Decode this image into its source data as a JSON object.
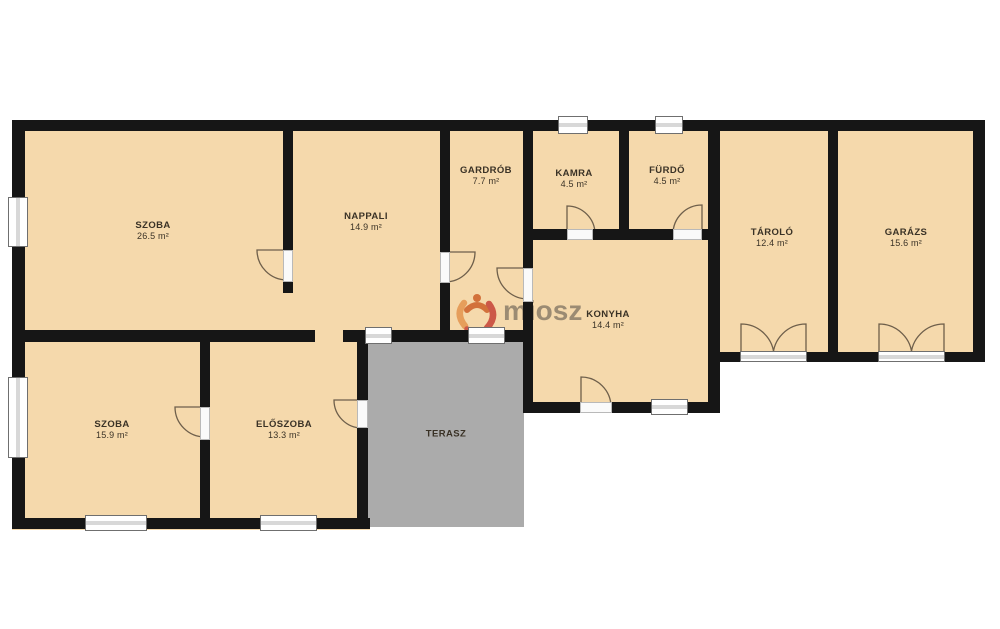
{
  "canvas": {
    "width": 1000,
    "height": 629,
    "background": "#ffffff"
  },
  "colors": {
    "wall": "#161616",
    "floor": "#f5d9ac",
    "terrace": "#ababab",
    "door_arc": "#6e5f4b",
    "label_text": "#3a3226",
    "watermark_text_color": "#8c7e6a",
    "logo_orange": "#e59a55",
    "logo_dark_orange": "#d06a33",
    "logo_red": "#c94f41"
  },
  "watermark": {
    "text": "miosz"
  },
  "rooms": [
    {
      "id": "szoba-1",
      "name": "SZOBA",
      "area": "26.5 m²",
      "cx": 153,
      "cy": 231
    },
    {
      "id": "nappali",
      "name": "NAPPALI",
      "area": "14.9 m²",
      "cx": 366,
      "cy": 222
    },
    {
      "id": "gardrob",
      "name": "GARDRÓB",
      "area": "7.7 m²",
      "cx": 486,
      "cy": 176
    },
    {
      "id": "kamra",
      "name": "KAMRA",
      "area": "4.5 m²",
      "cx": 574,
      "cy": 179
    },
    {
      "id": "furdo",
      "name": "FÜRDŐ",
      "area": "4.5 m²",
      "cx": 667,
      "cy": 176
    },
    {
      "id": "tarolo",
      "name": "TÁROLÓ",
      "area": "12.4 m²",
      "cx": 772,
      "cy": 238
    },
    {
      "id": "garazs",
      "name": "GARÁZS",
      "area": "15.6 m²",
      "cx": 906,
      "cy": 238
    },
    {
      "id": "konyha",
      "name": "KONYHA",
      "area": "14.4 m²",
      "cx": 608,
      "cy": 320
    },
    {
      "id": "szoba-2",
      "name": "SZOBA",
      "area": "15.9 m²",
      "cx": 112,
      "cy": 430
    },
    {
      "id": "eloszoba",
      "name": "ELŐSZOBA",
      "area": "13.3 m²",
      "cx": 284,
      "cy": 430
    },
    {
      "id": "terasz",
      "name": "TERASZ",
      "area": "",
      "cx": 446,
      "cy": 434
    }
  ],
  "floors": [
    {
      "id": "main-house",
      "x": 12,
      "y": 120,
      "w": 708,
      "h": 222,
      "fill": "floor"
    },
    {
      "id": "konyha-block",
      "x": 520,
      "y": 238,
      "w": 200,
      "h": 174,
      "fill": "floor"
    },
    {
      "id": "bottom-wing",
      "x": 12,
      "y": 330,
      "w": 358,
      "h": 200,
      "fill": "floor"
    },
    {
      "id": "east-wing",
      "x": 708,
      "y": 120,
      "w": 277,
      "h": 242,
      "fill": "floor"
    },
    {
      "id": "terasz-deck",
      "x": 357,
      "y": 333,
      "w": 167,
      "h": 194,
      "fill": "terrace"
    }
  ],
  "walls": [
    [
      12,
      120,
      973,
      11
    ],
    [
      523,
      229,
      197,
      11
    ],
    [
      12,
      330,
      303,
      12
    ],
    [
      343,
      330,
      22,
      12
    ],
    [
      392,
      330,
      76,
      12
    ],
    [
      505,
      330,
      28,
      12
    ],
    [
      523,
      402,
      57,
      11
    ],
    [
      612,
      402,
      41,
      11
    ],
    [
      688,
      402,
      32,
      11
    ],
    [
      708,
      352,
      32,
      10
    ],
    [
      807,
      352,
      71,
      10
    ],
    [
      945,
      352,
      40,
      10
    ],
    [
      12,
      518,
      75,
      11
    ],
    [
      147,
      518,
      115,
      11
    ],
    [
      317,
      518,
      53,
      11
    ],
    [
      12,
      120,
      13,
      77
    ],
    [
      12,
      247,
      13,
      130
    ],
    [
      12,
      458,
      13,
      71
    ],
    [
      283,
      120,
      10,
      130
    ],
    [
      283,
      282,
      10,
      11
    ],
    [
      440,
      120,
      10,
      132
    ],
    [
      440,
      283,
      10,
      59
    ],
    [
      523,
      120,
      10,
      148
    ],
    [
      523,
      302,
      10,
      110
    ],
    [
      619,
      120,
      10,
      120
    ],
    [
      708,
      120,
      12,
      292
    ],
    [
      828,
      120,
      10,
      242
    ],
    [
      973,
      120,
      12,
      242
    ],
    [
      200,
      340,
      10,
      67
    ],
    [
      200,
      440,
      10,
      89
    ],
    [
      357,
      330,
      11,
      70
    ],
    [
      357,
      428,
      11,
      101
    ]
  ],
  "windows": [
    {
      "x": 8,
      "y": 197,
      "w": 20,
      "h": 50,
      "o": "v"
    },
    {
      "x": 8,
      "y": 377,
      "w": 20,
      "h": 81,
      "o": "v"
    },
    {
      "x": 558,
      "y": 116,
      "w": 30,
      "h": 18,
      "o": "h"
    },
    {
      "x": 655,
      "y": 116,
      "w": 28,
      "h": 18,
      "o": "h"
    },
    {
      "x": 365,
      "y": 327,
      "w": 27,
      "h": 17,
      "o": "h"
    },
    {
      "x": 468,
      "y": 327,
      "w": 37,
      "h": 17,
      "o": "h"
    },
    {
      "x": 651,
      "y": 399,
      "w": 37,
      "h": 16,
      "o": "h"
    },
    {
      "x": 85,
      "y": 515,
      "w": 62,
      "h": 16,
      "o": "h"
    },
    {
      "x": 260,
      "y": 515,
      "w": 57,
      "h": 16,
      "o": "h"
    },
    {
      "x": 740,
      "y": 351,
      "w": 67,
      "h": 11,
      "o": "h"
    },
    {
      "x": 878,
      "y": 351,
      "w": 67,
      "h": 11,
      "o": "h"
    }
  ],
  "door_sills": [
    {
      "x": 283,
      "y": 250,
      "w": 10,
      "h": 32
    },
    {
      "x": 440,
      "y": 252,
      "w": 10,
      "h": 31
    },
    {
      "x": 523,
      "y": 268,
      "w": 10,
      "h": 34
    },
    {
      "x": 567,
      "y": 229,
      "w": 26,
      "h": 11
    },
    {
      "x": 673,
      "y": 229,
      "w": 29,
      "h": 11
    },
    {
      "x": 580,
      "y": 402,
      "w": 32,
      "h": 11
    },
    {
      "x": 200,
      "y": 407,
      "w": 10,
      "h": 33
    },
    {
      "x": 357,
      "y": 400,
      "w": 11,
      "h": 28
    }
  ],
  "doors": [
    {
      "id": "door-szoba1-nappali",
      "hx": 287,
      "hy": 250,
      "r": 30,
      "leaf": [
        -1,
        0
      ],
      "wall": [
        0,
        1
      ]
    },
    {
      "id": "door-nappali-gardrob",
      "hx": 445,
      "hy": 252,
      "r": 30,
      "leaf": [
        1,
        0
      ],
      "wall": [
        0,
        1
      ]
    },
    {
      "id": "door-gardrob-konyha",
      "hx": 528,
      "hy": 268,
      "r": 31,
      "leaf": [
        -1,
        0
      ],
      "wall": [
        0,
        1
      ]
    },
    {
      "id": "door-kamra",
      "hx": 567,
      "hy": 234,
      "r": 28,
      "leaf": [
        0,
        -1
      ],
      "wall": [
        1,
        0
      ]
    },
    {
      "id": "door-furdo",
      "hx": 702,
      "hy": 234,
      "r": 29,
      "leaf": [
        0,
        -1
      ],
      "wall": [
        -1,
        0
      ]
    },
    {
      "id": "door-konyha-terasz",
      "hx": 581,
      "hy": 407,
      "r": 30,
      "leaf": [
        0,
        -1
      ],
      "wall": [
        1,
        0
      ]
    },
    {
      "id": "door-szoba2-eloszoba",
      "hx": 205,
      "hy": 407,
      "r": 30,
      "leaf": [
        -1,
        0
      ],
      "wall": [
        0,
        1
      ]
    },
    {
      "id": "door-eloszoba-terasz",
      "hx": 362,
      "hy": 400,
      "r": 28,
      "leaf": [
        -1,
        0
      ],
      "wall": [
        0,
        1
      ]
    },
    {
      "id": "door-tarolo-left",
      "hx": 741,
      "hy": 357,
      "r": 33,
      "leaf": [
        0,
        -1
      ],
      "wall": [
        1,
        0
      ]
    },
    {
      "id": "door-tarolo-right",
      "hx": 806,
      "hy": 357,
      "r": 33,
      "leaf": [
        0,
        -1
      ],
      "wall": [
        -1,
        0
      ]
    },
    {
      "id": "door-garazs-left",
      "hx": 879,
      "hy": 357,
      "r": 33,
      "leaf": [
        0,
        -1
      ],
      "wall": [
        1,
        0
      ]
    },
    {
      "id": "door-garazs-right",
      "hx": 944,
      "hy": 357,
      "r": 33,
      "leaf": [
        0,
        -1
      ],
      "wall": [
        -1,
        0
      ]
    }
  ]
}
